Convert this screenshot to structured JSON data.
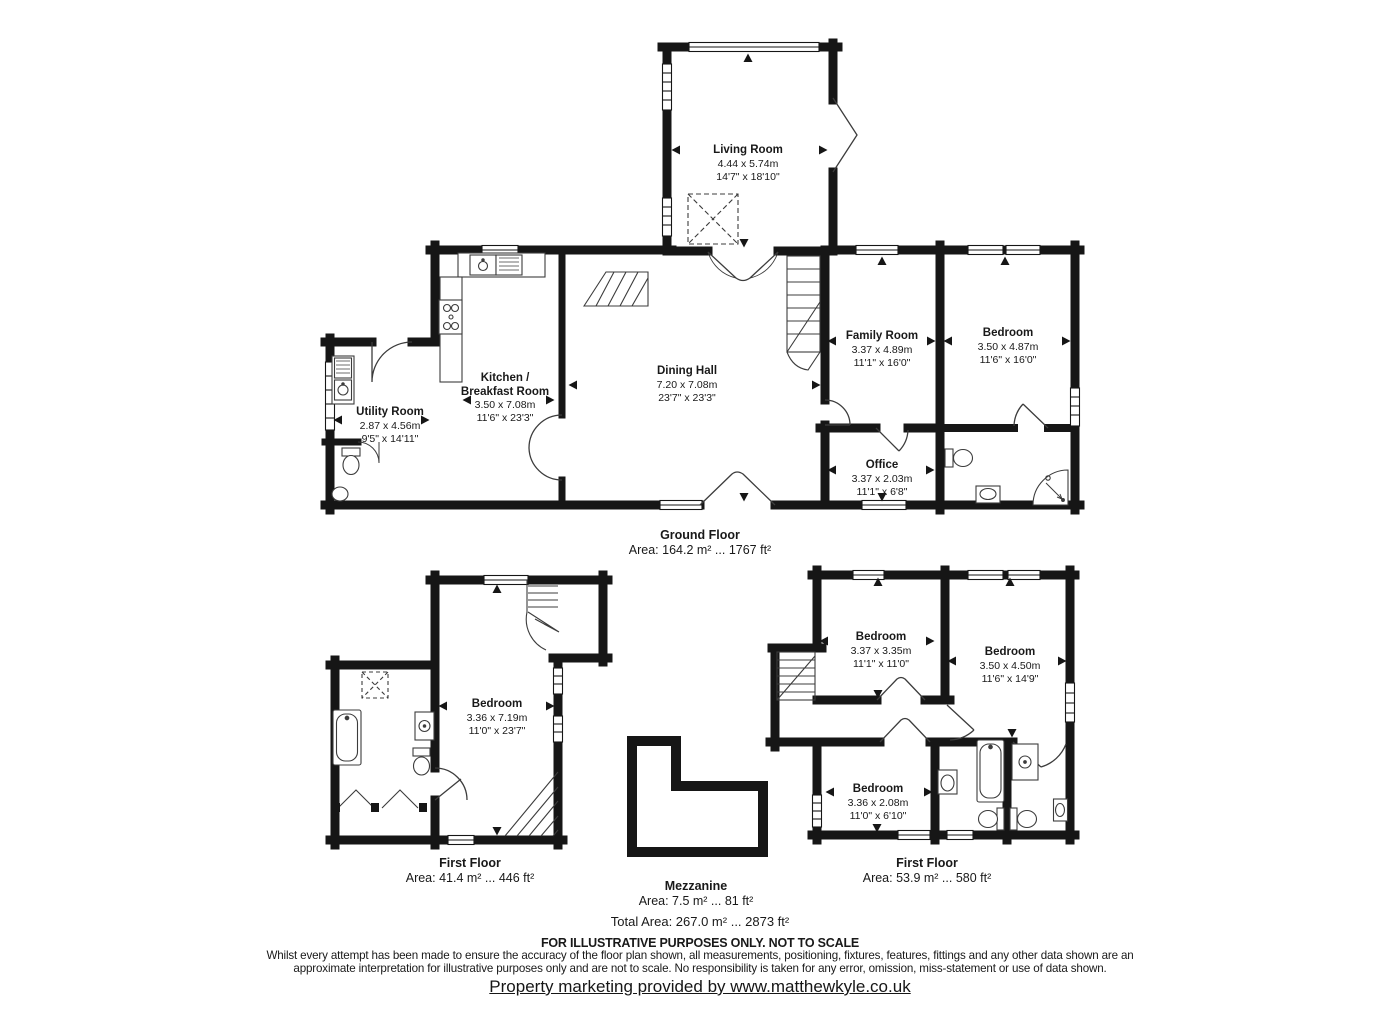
{
  "plan": {
    "rooms": [
      {
        "name": "Living Room",
        "metric": "4.44 x 5.74m",
        "imperial": "14'7\" x 18'10\""
      },
      {
        "name": "Utility Room",
        "metric": "2.87 x 4.56m",
        "imperial": "9'5\" x 14'11\""
      },
      {
        "name": "Kitchen /",
        "name2": "Breakfast Room",
        "metric": "3.50 x 7.08m",
        "imperial": "11'6\" x 23'3\""
      },
      {
        "name": "Dining Hall",
        "metric": "7.20 x 7.08m",
        "imperial": "23'7\" x 23'3\""
      },
      {
        "name": "Family Room",
        "metric": "3.37 x 4.89m",
        "imperial": "11'1\" x 16'0\""
      },
      {
        "name": "Bedroom",
        "metric": "3.50 x 4.87m",
        "imperial": "11'6\" x 16'0\""
      },
      {
        "name": "Office",
        "metric": "3.37 x 2.03m",
        "imperial": "11'1\" x 6'8\""
      },
      {
        "name": "Bedroom",
        "metric": "3.36 x 7.19m",
        "imperial": "11'0\" x 23'7\""
      },
      {
        "name": "Bedroom",
        "metric": "3.37 x 3.35m",
        "imperial": "11'1\" x 11'0\""
      },
      {
        "name": "Bedroom",
        "metric": "3.50 x 4.50m",
        "imperial": "11'6\" x 14'9\""
      },
      {
        "name": "Bedroom",
        "metric": "3.36 x 2.08m",
        "imperial": "11'0\" x 6'10\""
      }
    ],
    "floors": [
      {
        "label": "Ground Floor",
        "area": "Area: 164.2 m² ... 1767 ft²"
      },
      {
        "label": "First Floor",
        "area": "Area: 41.4 m² ... 446 ft²"
      },
      {
        "label": "Mezzanine",
        "area": "Area: 7.5 m² ... 81 ft²"
      },
      {
        "label": "First Floor",
        "area": "Area: 53.9 m² ... 580 ft²"
      }
    ],
    "total_area": "Total Area: 267.0 m² ... 2873 ft²",
    "notice": "FOR ILLUSTRATIVE PURPOSES ONLY. NOT TO SCALE",
    "disclaimer_line1": "Whilst every attempt has been made to ensure the accuracy of the floor plan shown, all measurements, positioning, fixtures, features, fittings and any other data shown are an",
    "disclaimer_line2": "approximate interpretation for illustrative purposes only and are not to scale. No responsibility is taken for any error, omission, miss-statement or use of data shown.",
    "footer_link": "Property marketing provided by www.matthewkyle.co.uk"
  }
}
